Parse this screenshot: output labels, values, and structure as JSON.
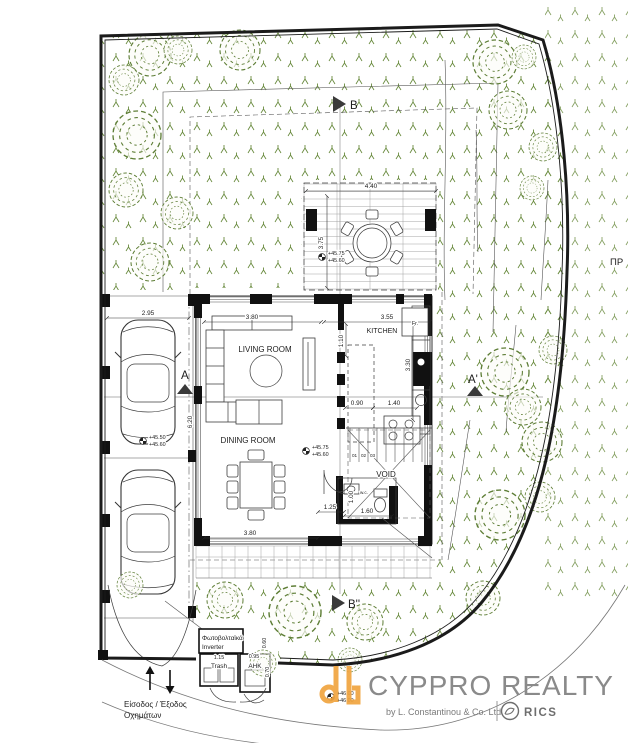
{
  "plan": {
    "rooms": {
      "living": "LIVING ROOM",
      "dining": "DINING ROOM",
      "kitchen": "KITCHEN",
      "void": "VOID",
      "wc": "w.c.",
      "fridge": "Fr."
    },
    "sections": {
      "a": "A",
      "a_prime": "A'",
      "b": "B",
      "b_prime": "B''"
    },
    "stairs": {
      "n1": "01",
      "n2": "02",
      "n3": "03"
    },
    "dims": {
      "pergola_w": "4.40",
      "pergola_d": "3.75",
      "parking_w": "2.95",
      "living_w": "3.80",
      "kitchen_w": "3.55",
      "entry_d": "1.10",
      "kitchen_d": "3.30",
      "island_gap": "0.90",
      "counter_w": "1.40",
      "living_d": "6.20",
      "hall_w": "1.25",
      "wc_w": "1.60",
      "wc_d": "1.00",
      "terrace_w": "3.80",
      "trash_w": "1.15",
      "ahk_w": "0.95",
      "pv_d": "0.60",
      "ahk_d": "0.70"
    },
    "levels": {
      "pergola_top": "+45.75",
      "pergola_bottom": "+45.60",
      "dining_top": "+45.75",
      "dining_bottom": "+45.60",
      "parking_top": "+45.50",
      "parking_bottom": "+45.60",
      "road_top": "+46.00",
      "road_bottom": "+46.00"
    },
    "utility": {
      "pv1": "Φωτοβολταϊκά",
      "pv2": "Inverter",
      "trash": "Trash",
      "ahk": "ΑΗΚ"
    },
    "entrance": {
      "line1": "Είσοδος / Έξοδος",
      "line2": "Οχημάτων"
    },
    "edge_note": "ΠΡ"
  },
  "logo": {
    "brand": "CYPPRO REALTY",
    "byline": "by L. Constantinou & Co. Ltd",
    "rics": "RICS"
  },
  "colors": {
    "vegetation": "#5d7d35",
    "logo_orange": "#F0A43F",
    "logo_gray": "#8a8a8a",
    "rics_gray": "#6e6e6e",
    "ink": "#1d1d1d"
  }
}
